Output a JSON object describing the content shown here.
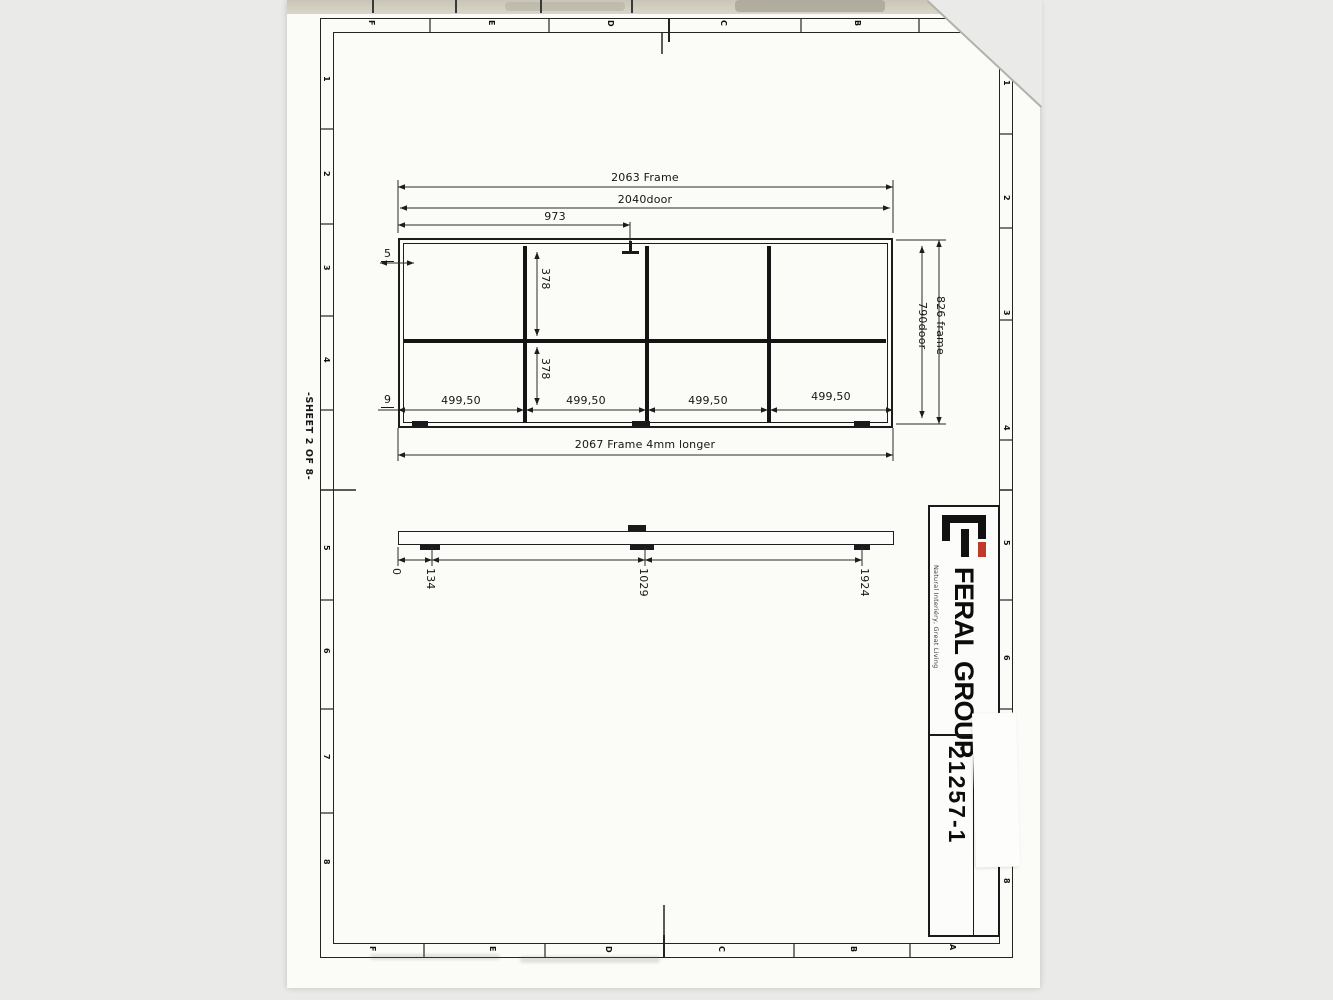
{
  "colors": {
    "background": "#eaeae8",
    "paper": "#fbfbf8",
    "ink": "#1d1d1d",
    "logo_red": "#c0392b"
  },
  "sheet": {
    "sheet_label": "-SHEET 2 OF 8-",
    "zones": {
      "top": [
        "F",
        "E",
        "D",
        "C",
        "B"
      ],
      "bottom": [
        "F",
        "E",
        "D",
        "C",
        "B",
        "A"
      ],
      "left": [
        "1",
        "2",
        "3",
        "4",
        "5",
        "6",
        "7",
        "8"
      ],
      "right": [
        "1",
        "2",
        "3",
        "4",
        "5",
        "6",
        "7",
        "8"
      ]
    }
  },
  "front_view": {
    "dim_frame_width": "2063 Frame",
    "dim_door_width": "2040door",
    "dim_hanger_position": "973",
    "dim_offset_top": "5",
    "dim_offset_bottom": "9",
    "dim_row_heights": [
      "378",
      "378"
    ],
    "dim_panel_widths": [
      "499,50",
      "499,50",
      "499,50",
      "499,50"
    ],
    "dim_bottom_frame": "2067 Frame 4mm longer",
    "dim_frame_height": "826 frame",
    "dim_door_height": "790door"
  },
  "profile_view": {
    "dim_positions": [
      "0",
      "134",
      "1029",
      "1924"
    ]
  },
  "title_block": {
    "company": "FERAL GROUP",
    "tagline": "Natural Interiéry, Great Living",
    "dwg_no_label": "Číslo výkresu/DWG No.",
    "dwg_no_value": "21257-1"
  }
}
